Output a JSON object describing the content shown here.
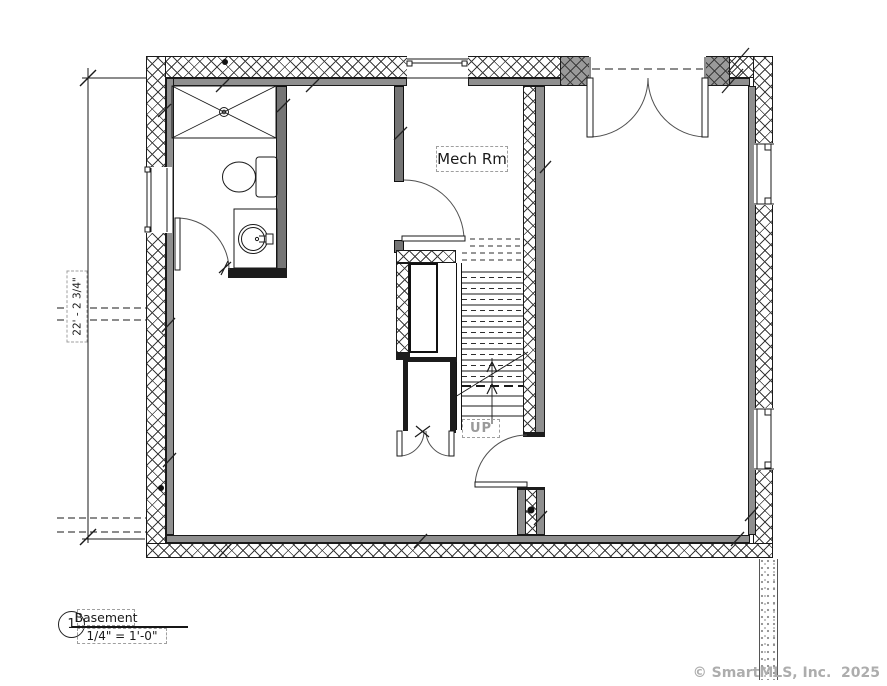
{
  "drawing": {
    "room_labels": {
      "mech_room": "Mech Rm"
    },
    "stair": {
      "direction_label": "UP"
    },
    "dimensions": {
      "left_overall": "22' - 2 3/4\""
    },
    "title_block": {
      "sheet_number": "1",
      "view_title": "Basement",
      "scale": "1/4\" = 1'-0\""
    },
    "watermark": "© SmartMLS, Inc.  2025",
    "colors": {
      "hatch_line": "#3c3c3c",
      "wall_liner_gray": "#8f8f8f",
      "partition_gray": "#757575",
      "pier_gray": "#9a9a9a",
      "ink": "#1a1a1a",
      "annotation_gray": "#9a9a9a",
      "watermark_gray": "#adadad"
    }
  }
}
